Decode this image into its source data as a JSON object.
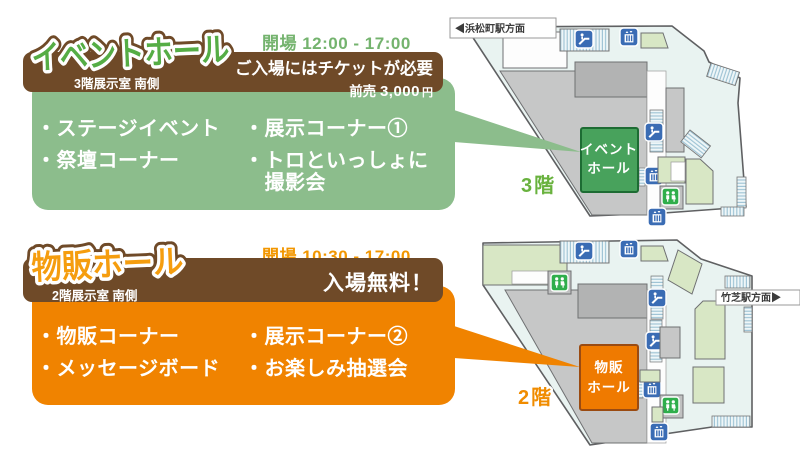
{
  "event_hall": {
    "hours": "開場 12:00 - 17:00",
    "title": "イベントホール",
    "subtitle": "3階展示室 南側",
    "notice": "ご入場にはチケットが必要",
    "price_prefix": "前売",
    "price_amount": "3,000",
    "price_unit": "円",
    "items": [
      "・ステージイベント",
      "・祭壇コーナー",
      "・展示コーナー①",
      "・トロといっしょに",
      "　撮影会"
    ]
  },
  "goods_hall": {
    "hours": "開場 10:30 - 17:00",
    "title": "物販ホール",
    "subtitle": "2階展示室 南側",
    "notice": "入場無料！",
    "items": [
      "・物販コーナー",
      "・メッセージボード",
      "・展示コーナー②",
      "・お楽しみ抽選会"
    ]
  },
  "map_3f": {
    "direction_label": "◀浜松町駅方面",
    "floor_label": "3階",
    "hall_line1": "イベント",
    "hall_line2": "ホール"
  },
  "map_2f": {
    "direction_label": "竹芝駅方面▶",
    "floor_label": "2階",
    "hall_line1": "物販",
    "hall_line2": "ホール"
  },
  "icons": {
    "escalator": "escalator-icon",
    "elevator": "elevator-icon",
    "restroom": "restroom-icon"
  },
  "colors": {
    "brown": "#6f4a28",
    "panel_green": "#8cbd8c",
    "hall_green": "#48a25c",
    "title_green": "#55ad45",
    "panel_orange": "#f08300",
    "hall_orange": "#ef7a00",
    "title_orange": "#f59d0e",
    "hours_green": "#74b36e",
    "hours_orange": "#f29600",
    "map_background": "#e9f3f1",
    "map_gray": "#c6c7c7",
    "map_room_green": "#d8e7c5",
    "icon_blue": "#3a6cb4",
    "restroom_green": "#2fae4b"
  }
}
